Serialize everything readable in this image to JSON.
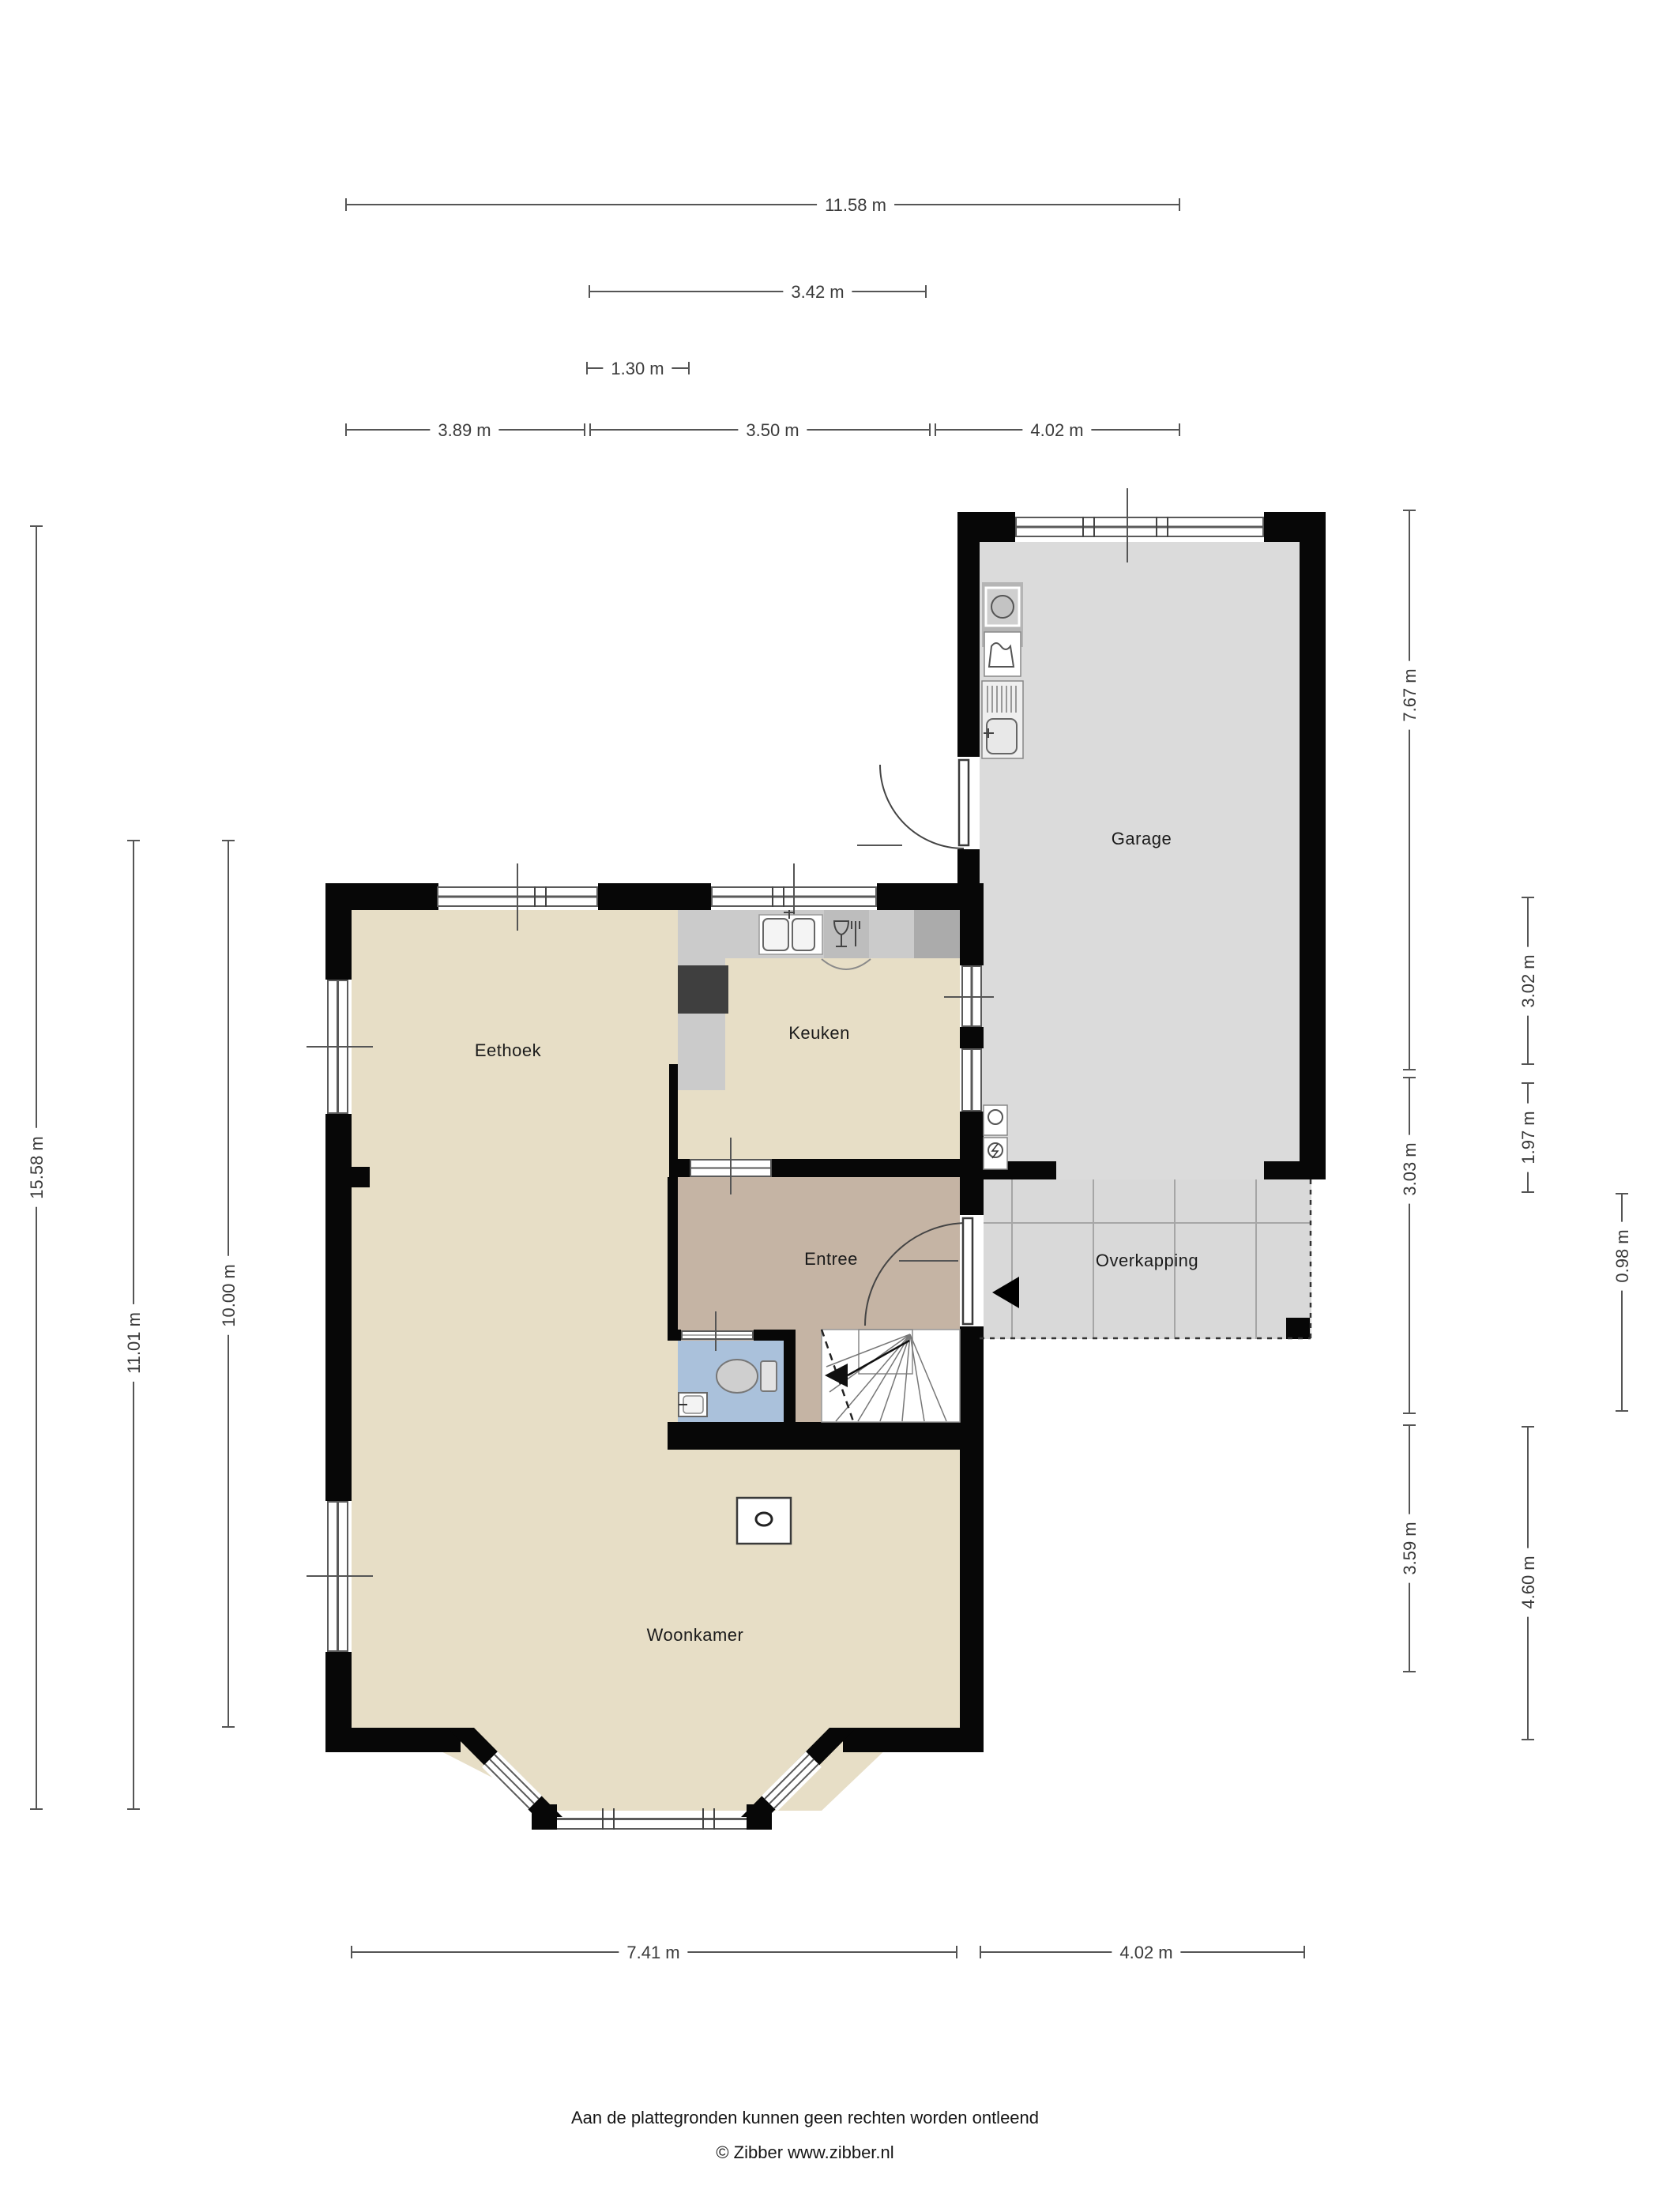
{
  "rooms": {
    "eethoek": "Eethoek",
    "keuken": "Keuken",
    "entree": "Entree",
    "garage": "Garage",
    "overkapping": "Overkapping",
    "woonkamer": "Woonkamer"
  },
  "dims": {
    "d1": "11.58 m",
    "d2": "3.42 m",
    "d3": "1.30 m",
    "d4": "3.89 m",
    "d5": "3.50 m",
    "d6": "4.02 m",
    "d7": "15.58 m",
    "d8": "11.01 m",
    "d9": "10.00 m",
    "d10": "7.67 m",
    "d11": "3.02 m",
    "d12": "3.03 m",
    "d13": "1.97 m",
    "d14": "0.98 m",
    "d15": "3.59 m",
    "d16": "4.60 m",
    "d17": "7.41 m",
    "d18": "4.02 m"
  },
  "footer": {
    "line1": "Aan de plattegronden kunnen geen rechten worden ontleend",
    "line2": "© Zibber www.zibber.nl"
  },
  "colors": {
    "floor_living": "#e7dec6",
    "floor_entree": "#c5b4a4",
    "floor_toilet": "#aac1db",
    "floor_garage": "#dbdbdb",
    "floor_overkapping": "#d9d9d9",
    "wall": "#070707",
    "counter": "#cbcbcb",
    "dimension_line": "#555555"
  }
}
